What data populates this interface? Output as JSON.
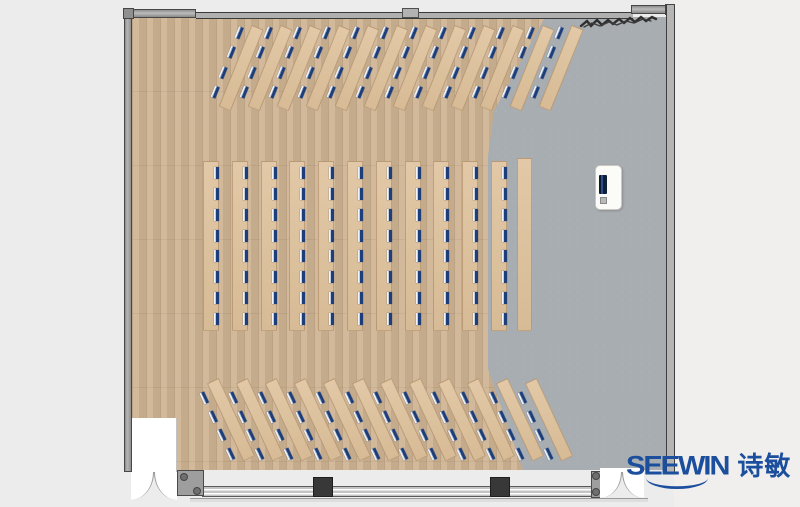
{
  "meta": {
    "title": "Lecture hall floor plan (top view render)"
  },
  "logo": {
    "brand": "SEEWIN",
    "brand_cn": "诗敏",
    "color": "#1b4f9e"
  },
  "palette": {
    "background": "#ececec",
    "wood_floor": "#cfb493",
    "gray_floor": "#a8adb1",
    "desk_wood": "#ddc29f",
    "seat_marker_blue": "#1d3e79",
    "wall_gray": "#a3a3a3",
    "pillar_dark": "#383838"
  },
  "floorplan": {
    "groups": [
      {
        "id": "top-rows",
        "desk_type": "diagonal",
        "angle_deg": 22,
        "desk_count": 12,
        "seats_per_desk": 4,
        "center_x_start": 236,
        "center_y": 66,
        "spacing": 29.05,
        "desk_length": 88,
        "desk_width": 13
      },
      {
        "id": "middle-columns",
        "desk_type": "vertical",
        "angle_deg": 0,
        "desk_count": 11,
        "seats_per_desk": 8,
        "left_start": 203,
        "top": 161,
        "spacing": 28.8,
        "desk_length": 170,
        "desk_width": 16
      },
      {
        "id": "bottom-rows",
        "desk_type": "diagonal",
        "angle_deg": -25,
        "desk_count": 12,
        "seats_per_desk": 4,
        "center_x_start": 226,
        "center_y": 422,
        "spacing": 28.9,
        "desk_length": 86,
        "desk_width": 13
      },
      {
        "id": "side-bench",
        "desk_type": "plain",
        "angle_deg": 0,
        "desk_count": 1,
        "seats_per_desk": 0,
        "left_start": 517,
        "top": 158,
        "spacing": 0,
        "desk_length": 173,
        "desk_width": 15
      }
    ],
    "total_seats": 184,
    "podium": {
      "present": true
    },
    "doors": [
      {
        "id": "entrance-bottom-left"
      },
      {
        "id": "entrance-bottom-right"
      }
    ]
  }
}
